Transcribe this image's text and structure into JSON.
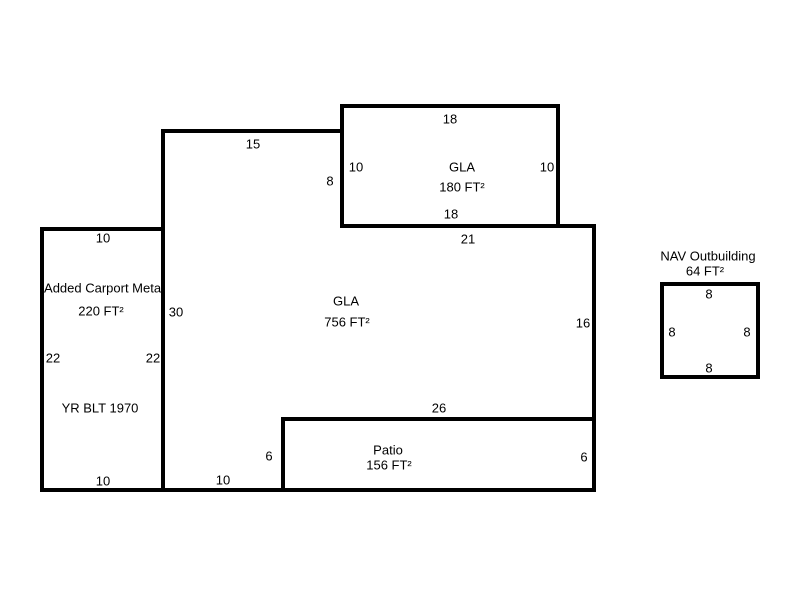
{
  "canvas": {
    "background": "#ffffff",
    "line_color": "#000000",
    "text_color": "#000000"
  },
  "areas": {
    "gla_addition": {
      "label": "GLA",
      "area": "180 FT²",
      "dim_top": "18",
      "dim_left": "10",
      "dim_right": "10",
      "dim_bottom": "18"
    },
    "gla_main": {
      "label": "GLA",
      "area": "756 FT²",
      "dim_top": "15",
      "dim_step_left": "8",
      "dim_upper_right": "21",
      "dim_right": "16",
      "dim_lower": "26",
      "dim_notch_left": "6",
      "dim_bottom": "10",
      "dim_left": "30"
    },
    "carport": {
      "label": "Added Carport Metal",
      "area": "220 FT²",
      "year_built": "YR BLT 1970",
      "dim_top": "10",
      "dim_left": "22",
      "dim_right": "22",
      "dim_bottom": "10"
    },
    "patio": {
      "label": "Patio",
      "area": "156 FT²",
      "dim_right": "6"
    },
    "outbuilding": {
      "label": "NAV Outbuilding",
      "area": "64 FT²",
      "dim_top": "8",
      "dim_left": "8",
      "dim_right": "8",
      "dim_bottom": "8"
    }
  }
}
